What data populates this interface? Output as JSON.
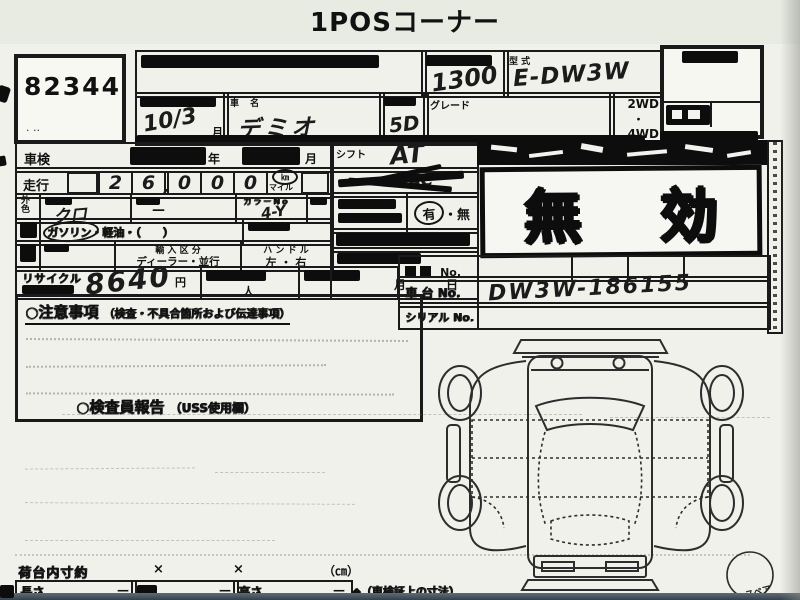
{
  "header": {
    "title": "1POSコーナー"
  },
  "lot": {
    "number": "82344",
    "marks": "· ··"
  },
  "spec": {
    "displacement": "1300",
    "model_label": "型 式",
    "model": "E-DW3W",
    "reg_date": "10/3",
    "reg_date_suffix": "月",
    "name_label": "車 名",
    "name": "デミオ",
    "doors": "5D",
    "grade_label": "グレード",
    "drive_2wd": "2WD",
    "drive_dot": "・",
    "drive_4wd": "4WD"
  },
  "left": {
    "shaken_label": "車検",
    "year": "年",
    "month": "月",
    "mileage_label": "走行",
    "mileage_digits": [
      "2",
      "6",
      "0",
      "0",
      "0"
    ],
    "comma": ",",
    "unit_km": "㎞",
    "unit_mile": "マイル",
    "color_label_1": "外",
    "color_label_2": "色",
    "color": "クロ",
    "color_change_dash": "—",
    "color_no_label": "カラーNo",
    "color_no": "4-Y",
    "fuel_text": "ガソリン・軽油・（　　）",
    "import_label": "輸 入 区 分",
    "import_value": "ディーラー・並行",
    "handle_label": "ハ ン ド ル",
    "handle_value": "左 ・ 右",
    "recycle_label": "リサイクル",
    "recycle_value": "8640",
    "recycle_unit": "円",
    "person_unit": "人"
  },
  "mid": {
    "shift_label": "シフト",
    "shift_value": "AT",
    "ac_value": "AC",
    "yes": "有",
    "no": "・無",
    "month": "月",
    "day": "日"
  },
  "stamp": {
    "char1": "無",
    "char2": "効"
  },
  "numbers": {
    "reg_suffix": "No.",
    "chassis_label": "車 台 No.",
    "chassis_value": "DW3W-186155",
    "serial_label": "シリアル No."
  },
  "notes": {
    "heading_main": "○注意事項",
    "heading_sub": "（検査・不具合箇所および伝達事項）",
    "inspector_main": "○検査員報告",
    "inspector_sub": "（USS使用欄）"
  },
  "dims": {
    "inner_label": "荷台内寸約",
    "x1": "×",
    "x2": "×",
    "unit": "（㎝）",
    "length": "長さ",
    "dash1": "—",
    "dash2": "—",
    "dash3": "—",
    "height": "高さ",
    "note": "◆（車検証上の寸法）"
  },
  "diagram": {
    "spare": "スペア"
  }
}
